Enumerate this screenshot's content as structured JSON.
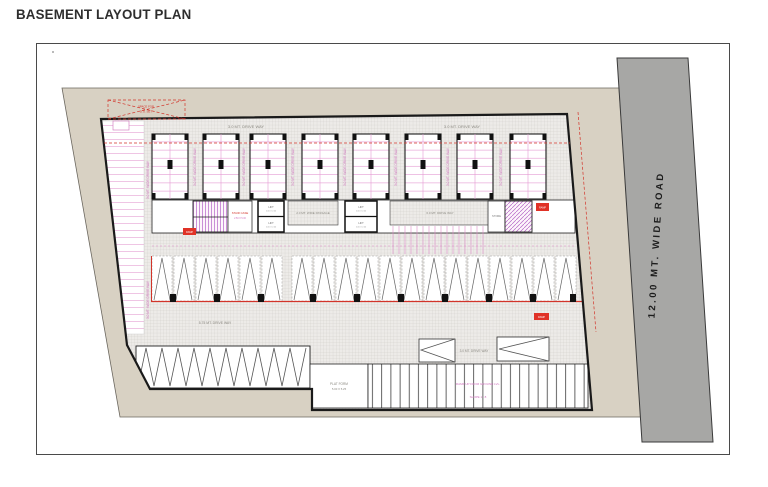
{
  "page": {
    "title": "BASEMENT LAYOUT PLAN"
  },
  "road": {
    "label": "12.00 MT. WIDE ROAD"
  },
  "colors": {
    "plot_fill": "#d8d1c3",
    "road_fill": "#a7a7a5",
    "wall_black": "#1a1a1a",
    "hatch_bg": "#edebe8",
    "dimension_red": "#d2342a",
    "stall_pink": "#d26ebe"
  },
  "plan": {
    "space_box": {
      "line1": "SPACE FOR",
      "line2": "D.G. SET"
    },
    "drives": {
      "top_left": "3.0 MT. DRIVE WAY",
      "top_right": "3.0 MT. DRIVE WAY",
      "aisle_vertical": "3.0 MT. WIDE DRIVE WAY",
      "left_vertical": "3.0 MT. WIDE DRIVE WAY",
      "passage": "2.0 MT. WIDE PASSAGE",
      "central": "6.0 MT. DRIVE WAY",
      "middle": "5.75 MT. DRIVE WAY",
      "lower": "3.0 MT. DRIVE WAY"
    },
    "rooms": {
      "stair_label": "STAIR CASE",
      "stair_size": "2.50 X 5.00",
      "store_label": "STORE",
      "lift_label": "LIFT",
      "lift_size": "2.00 X 2.00",
      "ramp_marker": "RAMP"
    },
    "platform": {
      "line1": "PLAT FORM",
      "line2": "5.00 X 5.25"
    },
    "ramp": {
      "line1": "RAMP UP FROM GROUND LVL.",
      "line2": "SLOPE 1 : 8"
    }
  }
}
